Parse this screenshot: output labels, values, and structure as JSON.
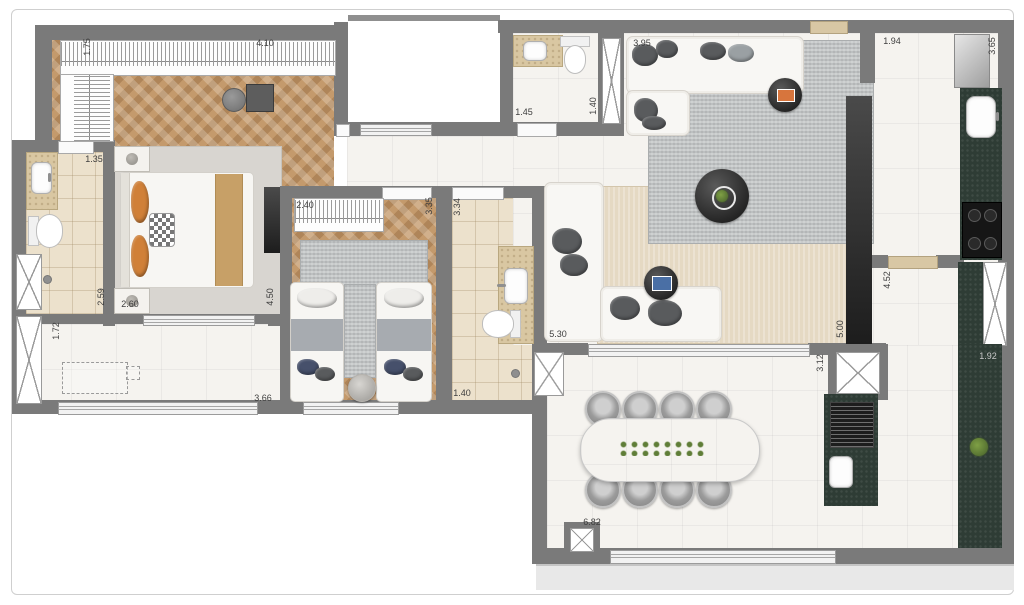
{
  "dims": {
    "master_wardrobe_depth": "1.75",
    "master_wardrobe_width": "4.10",
    "ensuite_width": "1.35",
    "ensuite_length": "2.59",
    "master_width": "2.60",
    "master_length": "4.50",
    "balcony_depth": "1.72",
    "balcony_width": "3.66",
    "bedroom2_wardrobe_width": "2.40",
    "bedroom2_length": "3.35",
    "bath2_length": "3.34",
    "bath2_width": "1.40",
    "powder_width": "1.45",
    "powder_depth": "1.40",
    "living_width": "3.95",
    "kitchen_hall_width": "1.94",
    "kitchen_length": "3.65",
    "kitchen_corridor_length": "4.52",
    "living_length": "5.00",
    "living_left_length": "5.30",
    "service_shaft_width": "3.12",
    "gourmet_counter_length": "1.92",
    "terrace_width": "6.82"
  },
  "colors": {
    "wall": "#7a7a7a",
    "wood_floor": "#c49a6c",
    "marble_floor": "#f5f3ef",
    "bath_tile": "#ece1cc",
    "stone_vanity": "#d9c7a2",
    "dark_counter": "#2e3c35",
    "rug_gray": "#bdc0c1",
    "rug_beige": "#e5d9c3",
    "pillow_orange": "#d08038",
    "pillow_navy": "#46506b",
    "greenery": "#5f7d37"
  }
}
